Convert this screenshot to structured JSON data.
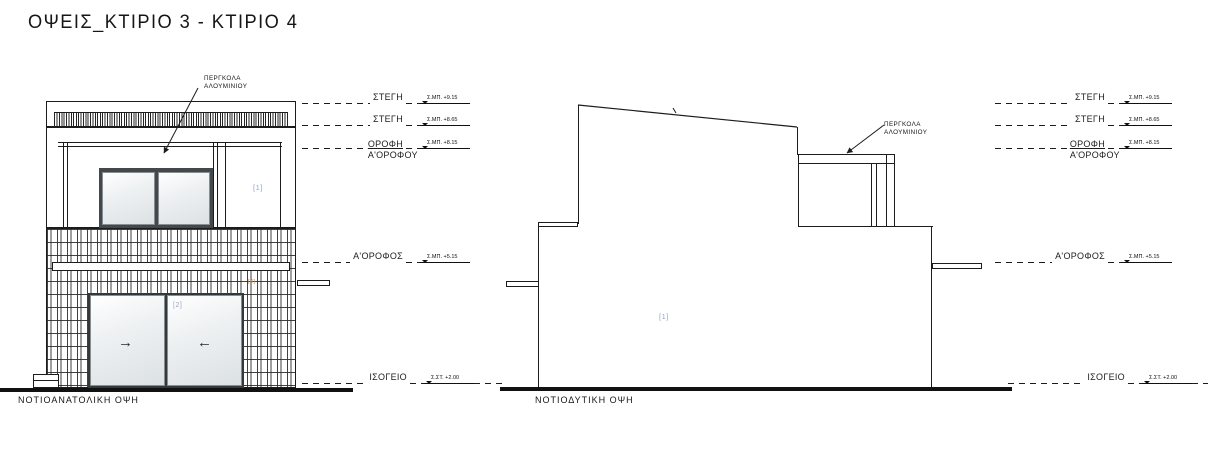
{
  "title": "ΟΨΕΙΣ_ΚΤΙΡΙΟ 3 - ΚΤΙΡΙΟ 4",
  "colors": {
    "line": "#1c1c1c",
    "tag_blue": "#98a6c4",
    "tag_orange": "#d08948",
    "glass": "#dce1e4"
  },
  "left_elevation": {
    "caption": "ΝΟΤΙΟΑΝΑΤΟΛΙΚΗ ΟΨΗ",
    "pergola_line1": "ΠΕΡΓΚΟΛΑ",
    "pergola_line2": "ΑΛΟΥΜΙΝΙΟΥ",
    "tag_upper": "[1]",
    "tag_door": "[2]",
    "tag_small": "[4]",
    "arrow_right": "→",
    "arrow_left": "←"
  },
  "right_elevation": {
    "caption": "ΝΟΤΙΟΔΥΤΙΚΗ ΟΨΗ",
    "pergola_line1": "ΠΕΡΓΚΟΛΑ",
    "pergola_line2": "ΑΛΟΥΜΙΝΙΟΥ",
    "tag_wall": "[1]"
  },
  "levels_left": [
    {
      "label": "ΣΤΕΓΗ",
      "value": "Σ.ΜΠ. +9.15"
    },
    {
      "label": "ΣΤΕΓΗ",
      "value": "Σ.ΜΠ. +8.65"
    },
    {
      "label": "ΟΡΟΦΗ",
      "label2": "Α'ΟΡΟΦΟΥ",
      "value": "Σ.ΜΠ. +8.15"
    },
    {
      "label": "Α'ΟΡΟΦΟΣ",
      "value": "Σ.ΜΠ. +5.15"
    },
    {
      "label": "ΙΣΟΓΕΙΟ",
      "value": "Σ.ΣΤ. +2.00"
    }
  ],
  "levels_right": [
    {
      "label": "ΣΤΕΓΗ",
      "value": "Σ.ΜΠ. +9.15"
    },
    {
      "label": "ΣΤΕΓΗ",
      "value": "Σ.ΜΠ. +8.65"
    },
    {
      "label": "ΟΡΟΦΗ",
      "label2": "Α'ΟΡΟΦΟΥ",
      "value": "Σ.ΜΠ. +8.15"
    },
    {
      "label": "Α'ΟΡΟΦΟΣ",
      "value": "Σ.ΜΠ. +5.15"
    },
    {
      "label": "ΙΣΟΓΕΙΟ",
      "value": "Σ.ΣΤ. +2.00"
    }
  ]
}
